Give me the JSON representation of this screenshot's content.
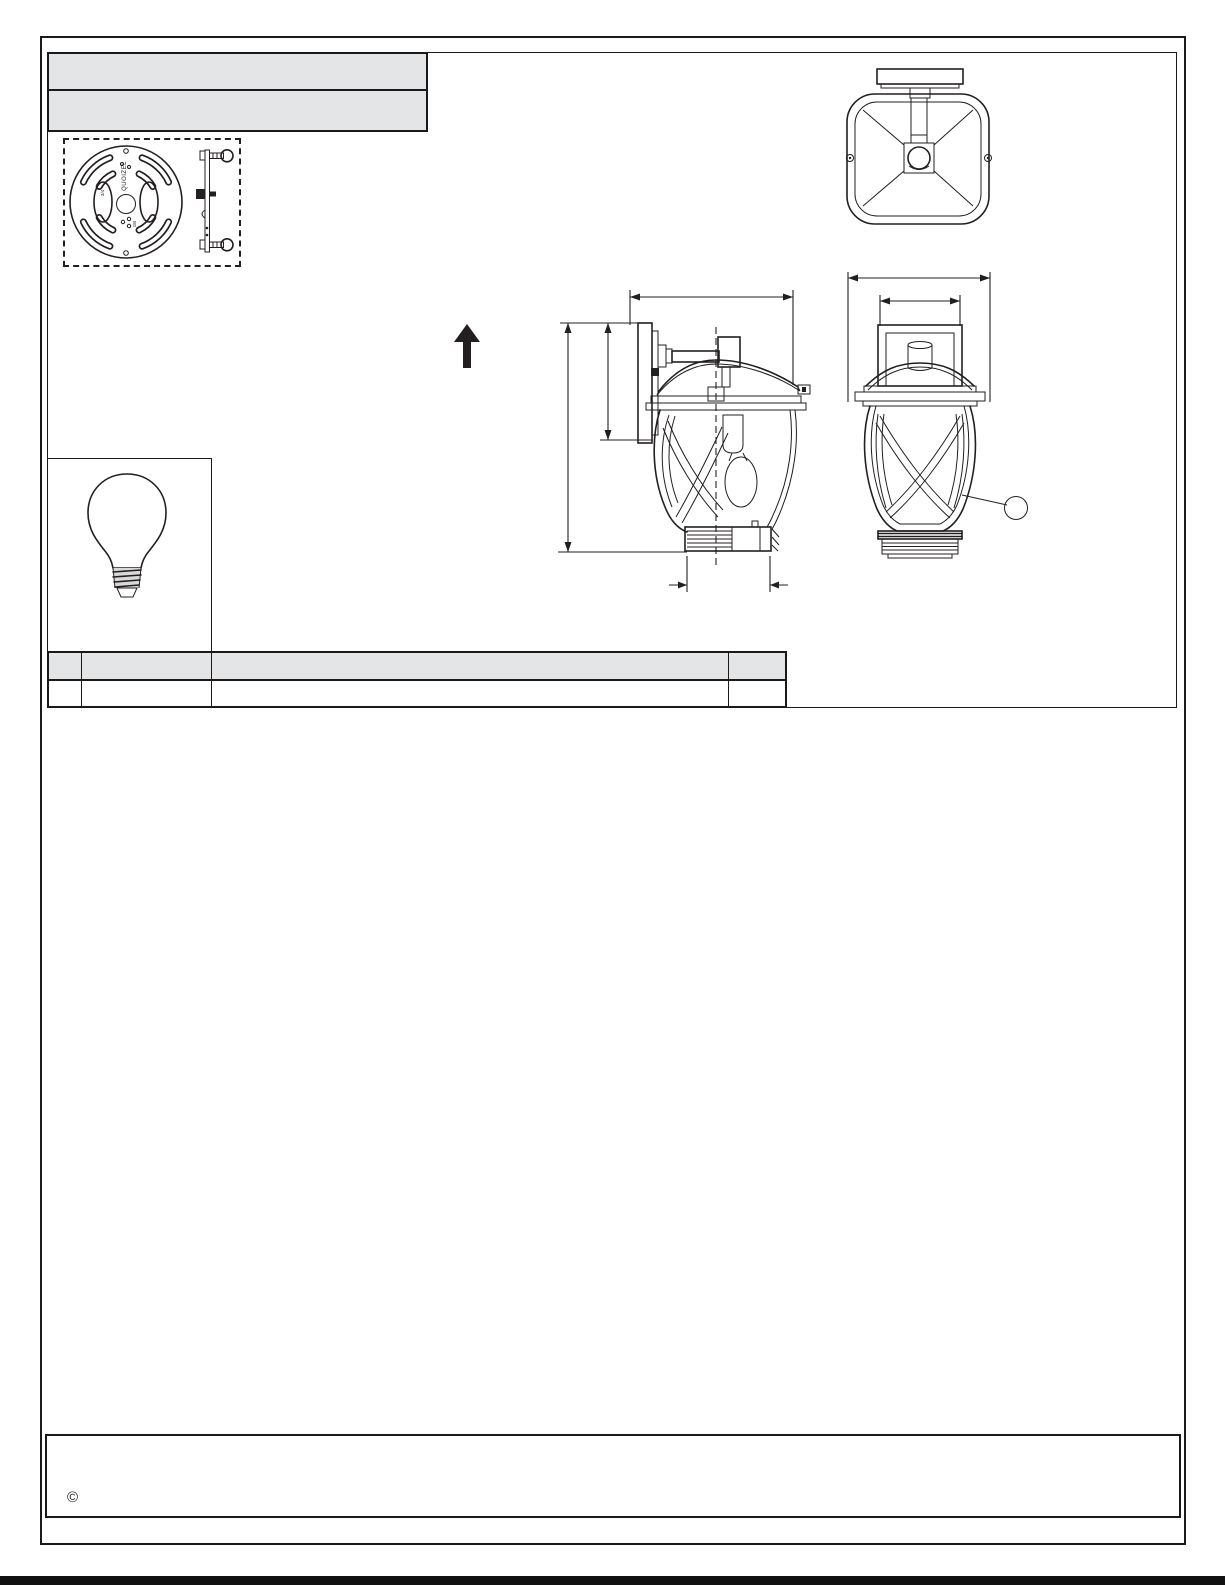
{
  "document": {
    "kind": "lighting-fixture-instruction-sheet",
    "copyright_symbol": "©"
  },
  "figures": {
    "mounting_plate": {
      "name": "mounting-crossbar-plate",
      "brand": "QUOIZEL",
      "left_mark": "3/4",
      "bottom_mark": "GB"
    },
    "mounting_bracket": "mounting-bracket-side-view",
    "top_view": "fixture-top-view",
    "side_view": "fixture-side-view-dimensioned",
    "front_view": "fixture-front-view-dimensioned",
    "bulb": "a19-bulb-diagram",
    "arrow": "up-arrow-orientation-mark",
    "callout": "empty-callout-balloon"
  },
  "table": {
    "header_cells": [
      "",
      "",
      "",
      ""
    ],
    "body_cells": [
      "",
      "",
      "",
      ""
    ]
  },
  "colors": {
    "line": "#231f20",
    "header_bar_fill": "#e4e5e7",
    "page_background": "#ffffff"
  }
}
